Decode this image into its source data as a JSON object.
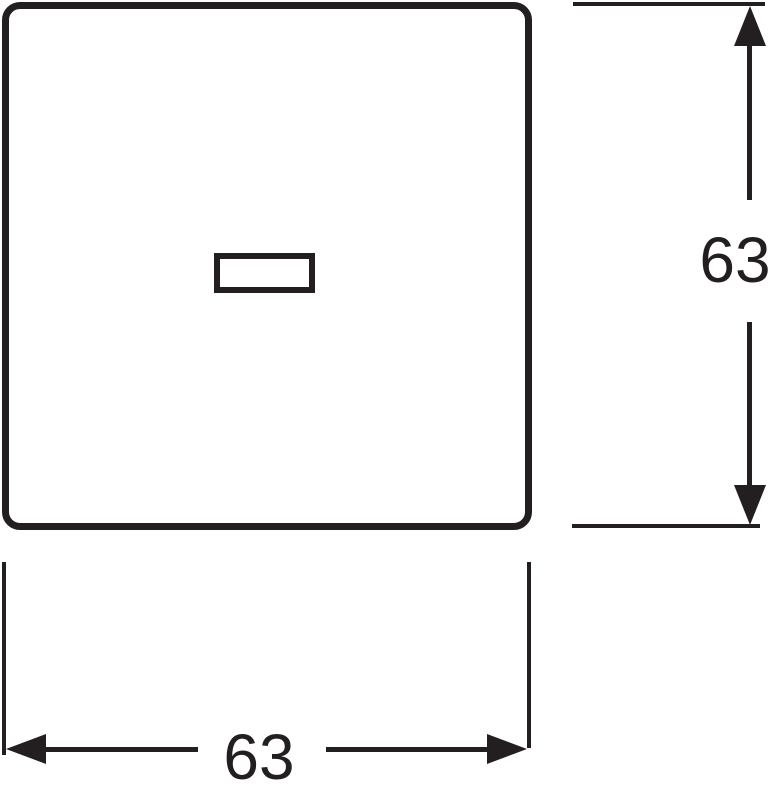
{
  "drawing": {
    "background_color": "#ffffff",
    "ink_color": "#231f20",
    "kind": "technical dimension drawing"
  },
  "dimensions": {
    "vertical": {
      "label": "63"
    },
    "horizontal": {
      "label": "63"
    }
  }
}
